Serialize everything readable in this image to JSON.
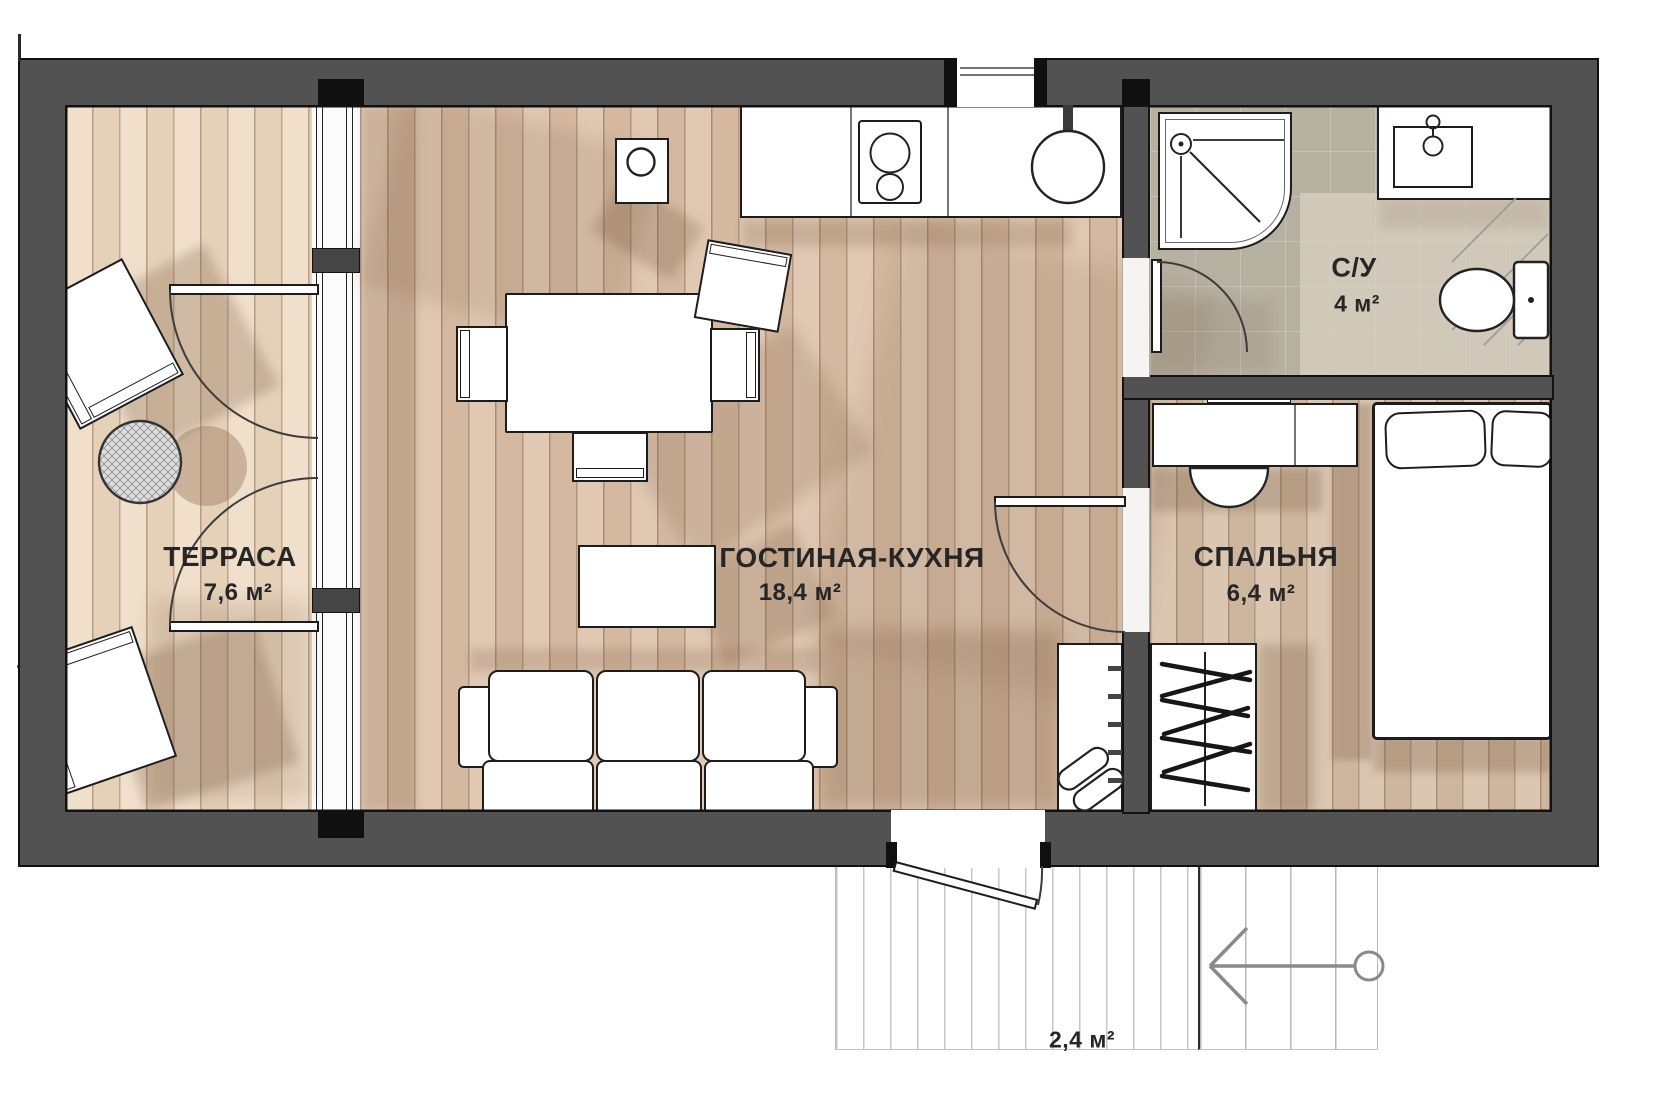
{
  "floorplan": {
    "rooms": {
      "terrace": {
        "name": "ТЕРРАСА",
        "area": "7,6 м²"
      },
      "living_kitchen": {
        "name": "ГОСТИНАЯ-КУХНЯ",
        "area": "18,4 м²"
      },
      "bedroom": {
        "name": "СПАЛЬНЯ",
        "area": "6,4 м²"
      },
      "bathroom": {
        "name": "С/У",
        "area": "4 м²"
      },
      "entrance_porch": {
        "area": "2,4 м²"
      }
    },
    "colors": {
      "wall": "#525252",
      "terrace_floor": "#eedbc4",
      "living_floor": "#dcc2aa",
      "bedroom_floor": "#d6bfa8",
      "bathroom_floor": "#b7b1a2",
      "label_text": "#262626"
    }
  }
}
